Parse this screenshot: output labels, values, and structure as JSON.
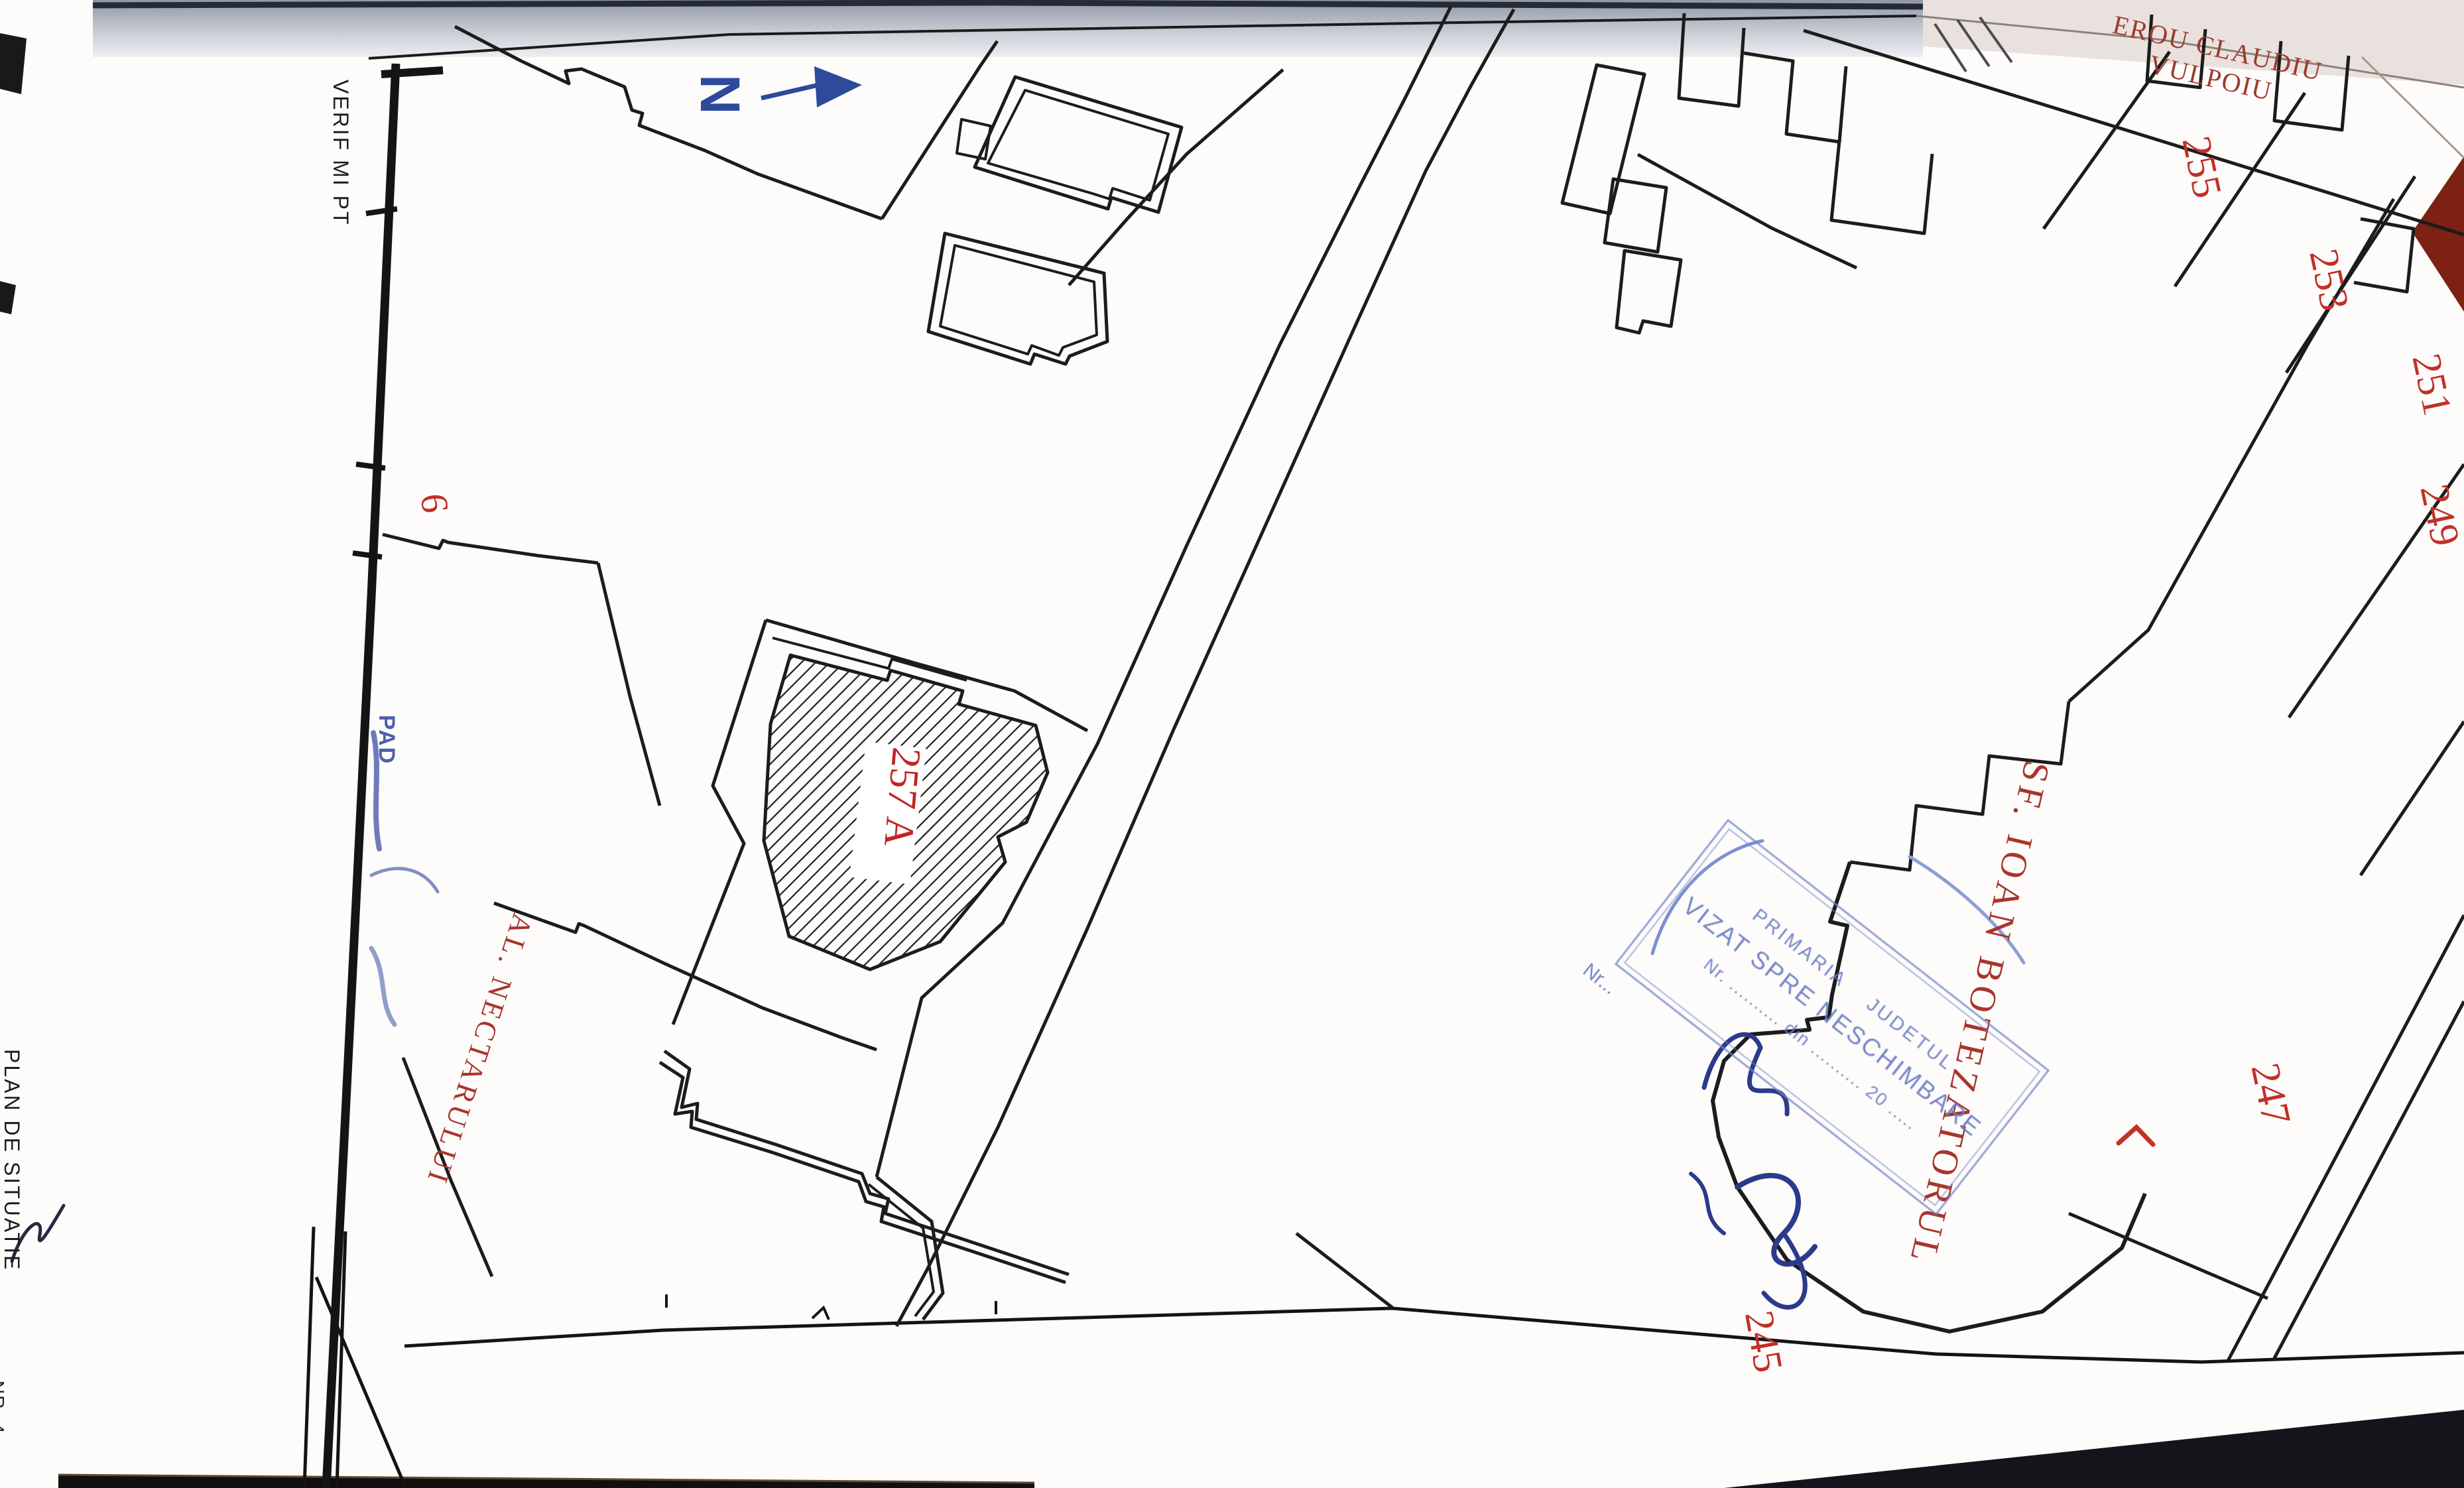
{
  "page": {
    "type_label": "PLAN DE SITUATIE",
    "verif_label": "VERIF MI PT",
    "corner_fragment": "NR. 4"
  },
  "north": {
    "letter": "N"
  },
  "streets": {
    "erou_line1": "EROU CLAUDIU",
    "erou_line2": "VULPOIU",
    "sf_ioan": "SF. IOAN BOTEZATORUL",
    "nectarului": "AL. NECTARULUI"
  },
  "parcels": {
    "p255": "255",
    "p253": "253",
    "p251": "251",
    "p249": "249",
    "p247": "247",
    "p245": "245",
    "p6": "6",
    "p257a": "257 A"
  },
  "stamp": {
    "line1_left": "PRIMARIA",
    "line1_right": "JUDETUL",
    "line2": "VIZAT SPRE NESCHIMBARE",
    "line3": "Nr. .......... din .......... 20 .....",
    "nr_fragment": "Nr...",
    "pad_fragment": "PAD"
  },
  "colors": {
    "map_line": "#1c1c1c",
    "parcel_number_red": "#c03028",
    "street_red": "#a8352c",
    "north_blue": "#2d4a9b",
    "stamp_blue": "#7084ca",
    "ink_blue": "#2b3a8c",
    "page_edge_dark_red": "#7c2113"
  }
}
